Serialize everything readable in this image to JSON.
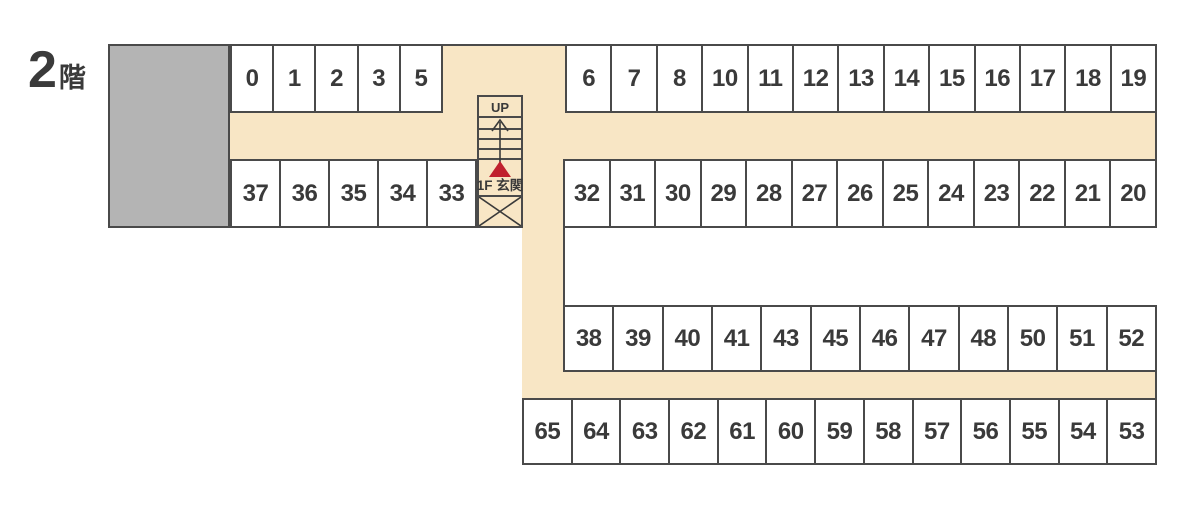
{
  "floor_label": {
    "number": "2",
    "suffix": "階"
  },
  "stairwell": {
    "up_label": "UP",
    "entrance_label": "1F 玄関"
  },
  "colors": {
    "corridor_beige": "#f8e6c5",
    "block_gray": "#b4b4b4",
    "outline_dark": "#4a4a4a",
    "text_dark": "#3a3a3a",
    "entrance_marker_red": "#c0212e",
    "background": "#ffffff"
  },
  "rows": [
    {
      "name": "upper-left",
      "cells": [
        "0",
        "1",
        "2",
        "3",
        "5"
      ]
    },
    {
      "name": "upper-right",
      "cells": [
        "6",
        "7",
        "8",
        "10",
        "11",
        "12",
        "13",
        "14",
        "15",
        "16",
        "17",
        "18",
        "19"
      ]
    },
    {
      "name": "second-left",
      "cells": [
        "37",
        "36",
        "35",
        "34",
        "33"
      ]
    },
    {
      "name": "second-right",
      "cells": [
        "32",
        "31",
        "30",
        "29",
        "28",
        "27",
        "26",
        "25",
        "24",
        "23",
        "22",
        "21",
        "20"
      ]
    },
    {
      "name": "third",
      "cells": [
        "38",
        "39",
        "40",
        "41",
        "43",
        "45",
        "46",
        "47",
        "48",
        "50",
        "51",
        "52"
      ]
    },
    {
      "name": "bottom",
      "cells": [
        "65",
        "64",
        "63",
        "62",
        "61",
        "60",
        "59",
        "58",
        "57",
        "56",
        "55",
        "54",
        "53"
      ]
    }
  ]
}
